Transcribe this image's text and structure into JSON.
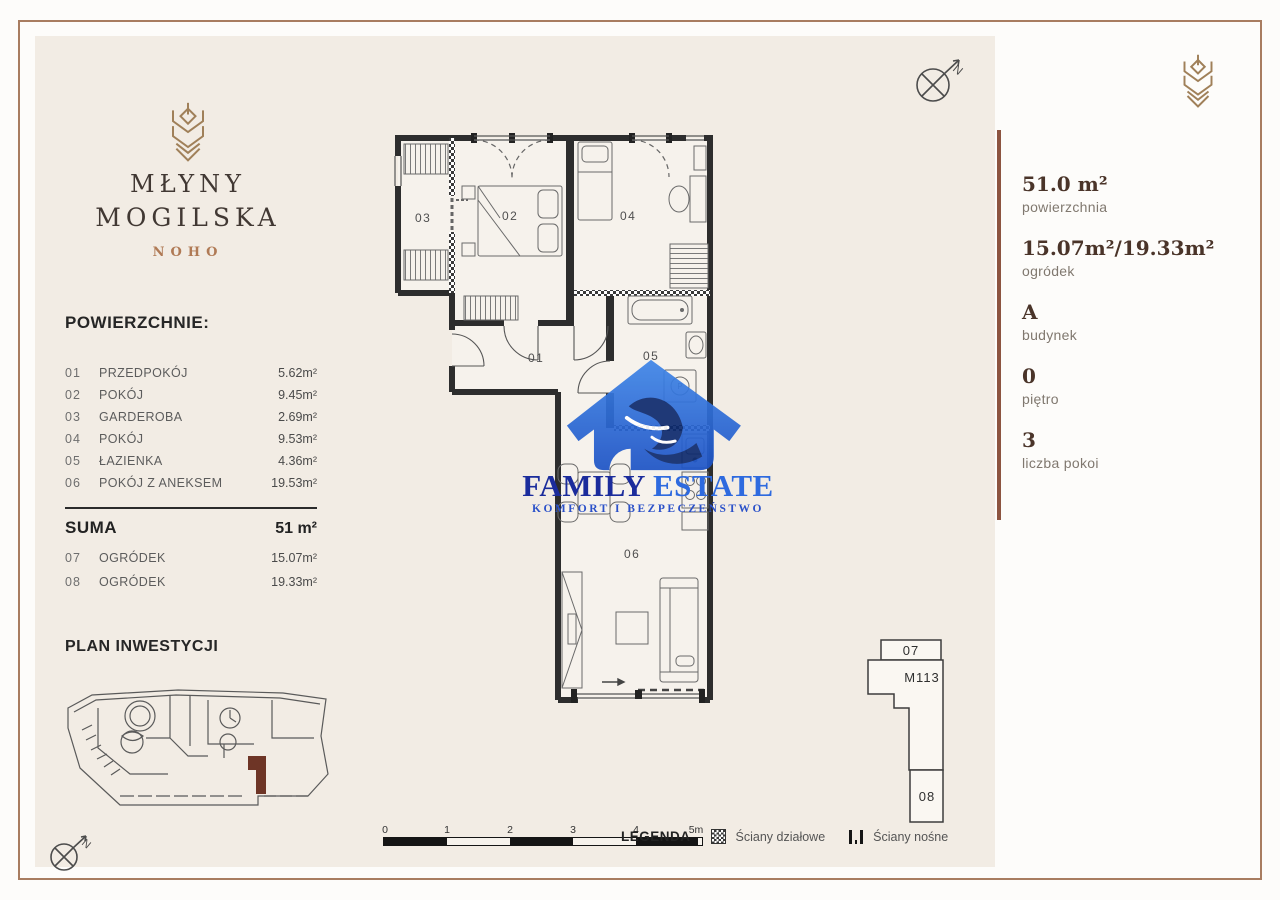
{
  "brand": {
    "title1": "MŁYNY",
    "title2": "MOGILSKA",
    "subtitle": "NOHO"
  },
  "surfaces": {
    "title": "POWIERZCHNIE:",
    "rows": [
      {
        "no": "01",
        "name": "PRZEDPOKÓJ",
        "area": "5.62m²"
      },
      {
        "no": "02",
        "name": "POKÓJ",
        "area": "9.45m²"
      },
      {
        "no": "03",
        "name": "GARDEROBA",
        "area": "2.69m²"
      },
      {
        "no": "04",
        "name": "POKÓJ",
        "area": "9.53m²"
      },
      {
        "no": "05",
        "name": "ŁAZIENKA",
        "area": "4.36m²"
      },
      {
        "no": "06",
        "name": "POKÓJ Z ANEKSEM",
        "area": "19.53m²"
      }
    ],
    "suma_label": "SUMA",
    "suma_value": "51 m²",
    "gardens": [
      {
        "no": "07",
        "name": "OGRÓDEK",
        "area": "15.07m²"
      },
      {
        "no": "08",
        "name": "OGRÓDEK",
        "area": "19.33m²"
      }
    ]
  },
  "plan_inwestycji_title": "PLAN INWESTYCJI",
  "floor_plan": {
    "labels": {
      "r1": "01",
      "r2": "02",
      "r3": "03",
      "r4": "04",
      "r5": "05",
      "r6": "06"
    },
    "washer": "P"
  },
  "compass": {
    "north": "N"
  },
  "watermark": {
    "brand1": "FAMILY",
    "brand2": "ESTATE",
    "tagline": "KOMFORT I BEZPECZEŃSTWO"
  },
  "sidebar": {
    "stats": [
      {
        "value": "51.0 m²",
        "label": "powierzchnia"
      },
      {
        "value": "15.07m²/19.33m²",
        "label": "ogródek"
      },
      {
        "value": "A",
        "label": "budynek"
      },
      {
        "value": "0",
        "label": "piętro"
      },
      {
        "value": "3",
        "label": "liczba pokoi"
      }
    ]
  },
  "unit_diagram": {
    "garden_top": "07",
    "unit": "M113",
    "garden_bottom": "08"
  },
  "scale": {
    "ticks": [
      "0",
      "1",
      "2",
      "3",
      "4",
      "5m"
    ]
  },
  "legend": {
    "title": "LEGENDA",
    "partition": "Ściany działowe",
    "bearing": "Ściany nośne"
  }
}
